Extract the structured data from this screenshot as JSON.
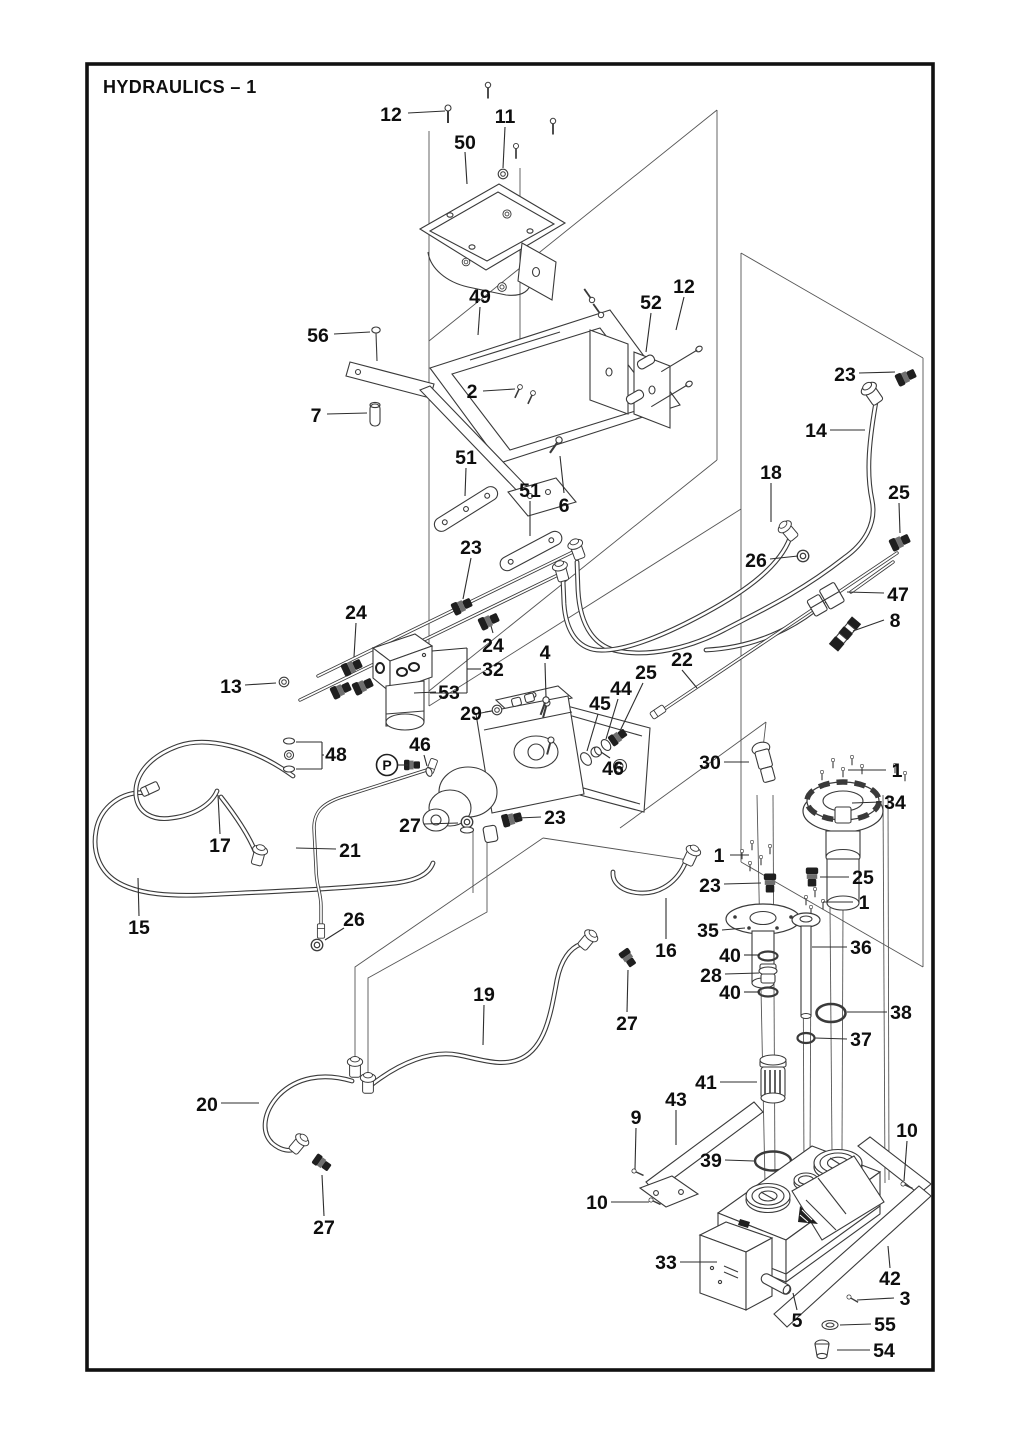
{
  "page": {
    "title": "HYDRAULICS – 1",
    "width": 1024,
    "height": 1435,
    "background": "#ffffff",
    "frame_color": "#111111",
    "line_color": "#3a3a3a",
    "label_color": "#0e0e0e"
  },
  "port_label": {
    "text": "P",
    "cx": 387,
    "cy": 765,
    "r": 10.5,
    "leader": [
      398,
      765,
      408,
      765
    ]
  },
  "callouts": [
    {
      "n": "12",
      "x": 391,
      "y": 114,
      "l": [
        408,
        113,
        445,
        111
      ]
    },
    {
      "n": "50",
      "x": 465,
      "y": 142,
      "l": [
        465,
        152,
        467,
        184
      ]
    },
    {
      "n": "11",
      "x": 505,
      "y": 116,
      "l": [
        505,
        127,
        503,
        168
      ]
    },
    {
      "n": "12",
      "x": 684,
      "y": 286,
      "l": [
        684,
        297,
        676,
        330
      ]
    },
    {
      "n": "52",
      "x": 651,
      "y": 302,
      "l": [
        651,
        313,
        646,
        352
      ]
    },
    {
      "n": "49",
      "x": 480,
      "y": 296,
      "l": [
        480,
        307,
        478,
        335
      ]
    },
    {
      "n": "56",
      "x": 318,
      "y": 335,
      "l": [
        334,
        334,
        370,
        332
      ]
    },
    {
      "n": "7",
      "x": 316,
      "y": 415,
      "l": [
        327,
        414,
        367,
        413
      ]
    },
    {
      "n": "2",
      "x": 472,
      "y": 391,
      "l": [
        483,
        391,
        515,
        389
      ]
    },
    {
      "n": "51",
      "x": 466,
      "y": 457,
      "l": [
        466,
        468,
        465,
        496
      ]
    },
    {
      "n": "51",
      "x": 530,
      "y": 490,
      "l": [
        530,
        501,
        530,
        536
      ]
    },
    {
      "n": "6",
      "x": 564,
      "y": 505,
      "l": [
        564,
        493,
        560,
        456
      ]
    },
    {
      "n": "23",
      "x": 471,
      "y": 547,
      "l": [
        471,
        558,
        463,
        599
      ]
    },
    {
      "n": "23",
      "x": 845,
      "y": 374,
      "l": [
        859,
        373,
        895,
        372
      ]
    },
    {
      "n": "14",
      "x": 816,
      "y": 430,
      "l": [
        830,
        430,
        865,
        430
      ]
    },
    {
      "n": "18",
      "x": 771,
      "y": 472,
      "l": [
        771,
        483,
        771,
        522
      ]
    },
    {
      "n": "26",
      "x": 756,
      "y": 560,
      "l": [
        770,
        559,
        798,
        556
      ]
    },
    {
      "n": "25",
      "x": 899,
      "y": 492,
      "l": [
        899,
        503,
        900,
        533
      ]
    },
    {
      "n": "47",
      "x": 898,
      "y": 594,
      "l": [
        884,
        593,
        847,
        592
      ]
    },
    {
      "n": "8",
      "x": 895,
      "y": 620,
      "l": [
        884,
        620,
        853,
        631
      ]
    },
    {
      "n": "24",
      "x": 356,
      "y": 612,
      "l": [
        356,
        623,
        354,
        657
      ]
    },
    {
      "n": "24",
      "x": 493,
      "y": 645,
      "l": [
        493,
        633,
        491,
        626
      ]
    },
    {
      "n": "13",
      "x": 231,
      "y": 686,
      "l": [
        245,
        685,
        276,
        683
      ]
    },
    {
      "n": "32",
      "x": 493,
      "y": 669
    },
    {
      "n": "53",
      "x": 449,
      "y": 692,
      "l": [
        436,
        692,
        414,
        693
      ]
    },
    {
      "n": "4",
      "x": 545,
      "y": 652,
      "l": [
        545,
        663,
        546,
        697
      ]
    },
    {
      "n": "29",
      "x": 471,
      "y": 713,
      "l": [
        485,
        712,
        492,
        711
      ]
    },
    {
      "n": "46",
      "x": 420,
      "y": 744,
      "l": [
        424,
        755,
        427,
        766
      ]
    },
    {
      "n": "46",
      "x": 613,
      "y": 768,
      "l": [
        610,
        758,
        601,
        752
      ]
    },
    {
      "n": "45",
      "x": 600,
      "y": 703,
      "l": [
        598,
        714,
        587,
        751
      ]
    },
    {
      "n": "44",
      "x": 621,
      "y": 688,
      "l": [
        618,
        699,
        606,
        739
      ]
    },
    {
      "n": "25",
      "x": 646,
      "y": 672,
      "l": [
        643,
        683,
        620,
        731
      ]
    },
    {
      "n": "22",
      "x": 682,
      "y": 659,
      "l": [
        682,
        670,
        697,
        688
      ]
    },
    {
      "n": "30",
      "x": 710,
      "y": 762,
      "l": [
        724,
        762,
        749,
        762
      ]
    },
    {
      "n": "1",
      "x": 897,
      "y": 770,
      "l": [
        886,
        770,
        848,
        770
      ]
    },
    {
      "n": "34",
      "x": 895,
      "y": 802,
      "l": [
        881,
        802,
        852,
        803
      ]
    },
    {
      "n": "1",
      "x": 719,
      "y": 855,
      "l": [
        730,
        855,
        749,
        855
      ]
    },
    {
      "n": "23",
      "x": 710,
      "y": 885,
      "l": [
        724,
        884,
        761,
        883
      ]
    },
    {
      "n": "25",
      "x": 863,
      "y": 877,
      "l": [
        849,
        877,
        820,
        877
      ]
    },
    {
      "n": "1",
      "x": 864,
      "y": 902,
      "l": [
        853,
        902,
        823,
        902
      ]
    },
    {
      "n": "35",
      "x": 708,
      "y": 930,
      "l": [
        722,
        930,
        745,
        928
      ]
    },
    {
      "n": "36",
      "x": 861,
      "y": 947,
      "l": [
        847,
        947,
        812,
        947
      ]
    },
    {
      "n": "40",
      "x": 730,
      "y": 955,
      "l": [
        744,
        955,
        760,
        955
      ]
    },
    {
      "n": "28",
      "x": 711,
      "y": 975,
      "l": [
        725,
        974,
        759,
        973
      ]
    },
    {
      "n": "40",
      "x": 730,
      "y": 992,
      "l": [
        744,
        992,
        760,
        992
      ]
    },
    {
      "n": "38",
      "x": 901,
      "y": 1012,
      "l": [
        887,
        1012,
        847,
        1012
      ]
    },
    {
      "n": "37",
      "x": 861,
      "y": 1039,
      "l": [
        847,
        1039,
        815,
        1038
      ]
    },
    {
      "n": "16",
      "x": 666,
      "y": 950,
      "l": [
        666,
        939,
        666,
        898
      ]
    },
    {
      "n": "15",
      "x": 139,
      "y": 927,
      "l": [
        139,
        916,
        138,
        878
      ]
    },
    {
      "n": "17",
      "x": 220,
      "y": 845,
      "l": [
        220,
        834,
        218,
        795
      ]
    },
    {
      "n": "21",
      "x": 350,
      "y": 850,
      "l": [
        336,
        849,
        296,
        848
      ]
    },
    {
      "n": "26",
      "x": 354,
      "y": 919,
      "l": [
        344,
        928,
        325,
        940
      ]
    },
    {
      "n": "27",
      "x": 410,
      "y": 825,
      "l": [
        424,
        824,
        458,
        823
      ]
    },
    {
      "n": "23",
      "x": 555,
      "y": 817,
      "l": [
        541,
        817,
        518,
        818
      ]
    },
    {
      "n": "27",
      "x": 627,
      "y": 1023,
      "l": [
        627,
        1012,
        628,
        970
      ]
    },
    {
      "n": "19",
      "x": 484,
      "y": 994,
      "l": [
        484,
        1005,
        483,
        1045
      ]
    },
    {
      "n": "20",
      "x": 207,
      "y": 1104,
      "l": [
        221,
        1103,
        259,
        1103
      ]
    },
    {
      "n": "27",
      "x": 324,
      "y": 1227,
      "l": [
        324,
        1216,
        322,
        1175
      ]
    },
    {
      "n": "41",
      "x": 706,
      "y": 1082,
      "l": [
        720,
        1082,
        757,
        1082
      ]
    },
    {
      "n": "43",
      "x": 676,
      "y": 1099,
      "l": [
        676,
        1110,
        676,
        1145
      ]
    },
    {
      "n": "9",
      "x": 636,
      "y": 1117,
      "l": [
        636,
        1128,
        635,
        1169
      ]
    },
    {
      "n": "10",
      "x": 907,
      "y": 1130,
      "l": [
        907,
        1141,
        904,
        1181
      ]
    },
    {
      "n": "39",
      "x": 711,
      "y": 1160,
      "l": [
        725,
        1160,
        754,
        1161
      ]
    },
    {
      "n": "10",
      "x": 597,
      "y": 1202,
      "l": [
        611,
        1202,
        649,
        1202
      ]
    },
    {
      "n": "33",
      "x": 666,
      "y": 1262,
      "l": [
        680,
        1262,
        717,
        1262
      ]
    },
    {
      "n": "42",
      "x": 890,
      "y": 1278,
      "l": [
        890,
        1268,
        888,
        1246
      ]
    },
    {
      "n": "3",
      "x": 905,
      "y": 1298,
      "l": [
        894,
        1298,
        857,
        1300
      ]
    },
    {
      "n": "5",
      "x": 797,
      "y": 1320,
      "l": [
        797,
        1310,
        793,
        1293
      ]
    },
    {
      "n": "55",
      "x": 885,
      "y": 1324,
      "l": [
        871,
        1324,
        840,
        1325
      ]
    },
    {
      "n": "54",
      "x": 884,
      "y": 1350,
      "l": [
        870,
        1350,
        837,
        1350
      ]
    },
    {
      "n": "48",
      "x": 336,
      "y": 754
    }
  ],
  "bracket_lines": [
    [
      481,
      669,
      467,
      669
    ],
    [
      467,
      648,
      467,
      693
    ],
    [
      467,
      648,
      432,
      651
    ],
    [
      467,
      693,
      430,
      693
    ],
    [
      324,
      755,
      322,
      755
    ],
    [
      322,
      742,
      322,
      769
    ],
    [
      322,
      742,
      296,
      742
    ],
    [
      322,
      769,
      296,
      769
    ]
  ]
}
